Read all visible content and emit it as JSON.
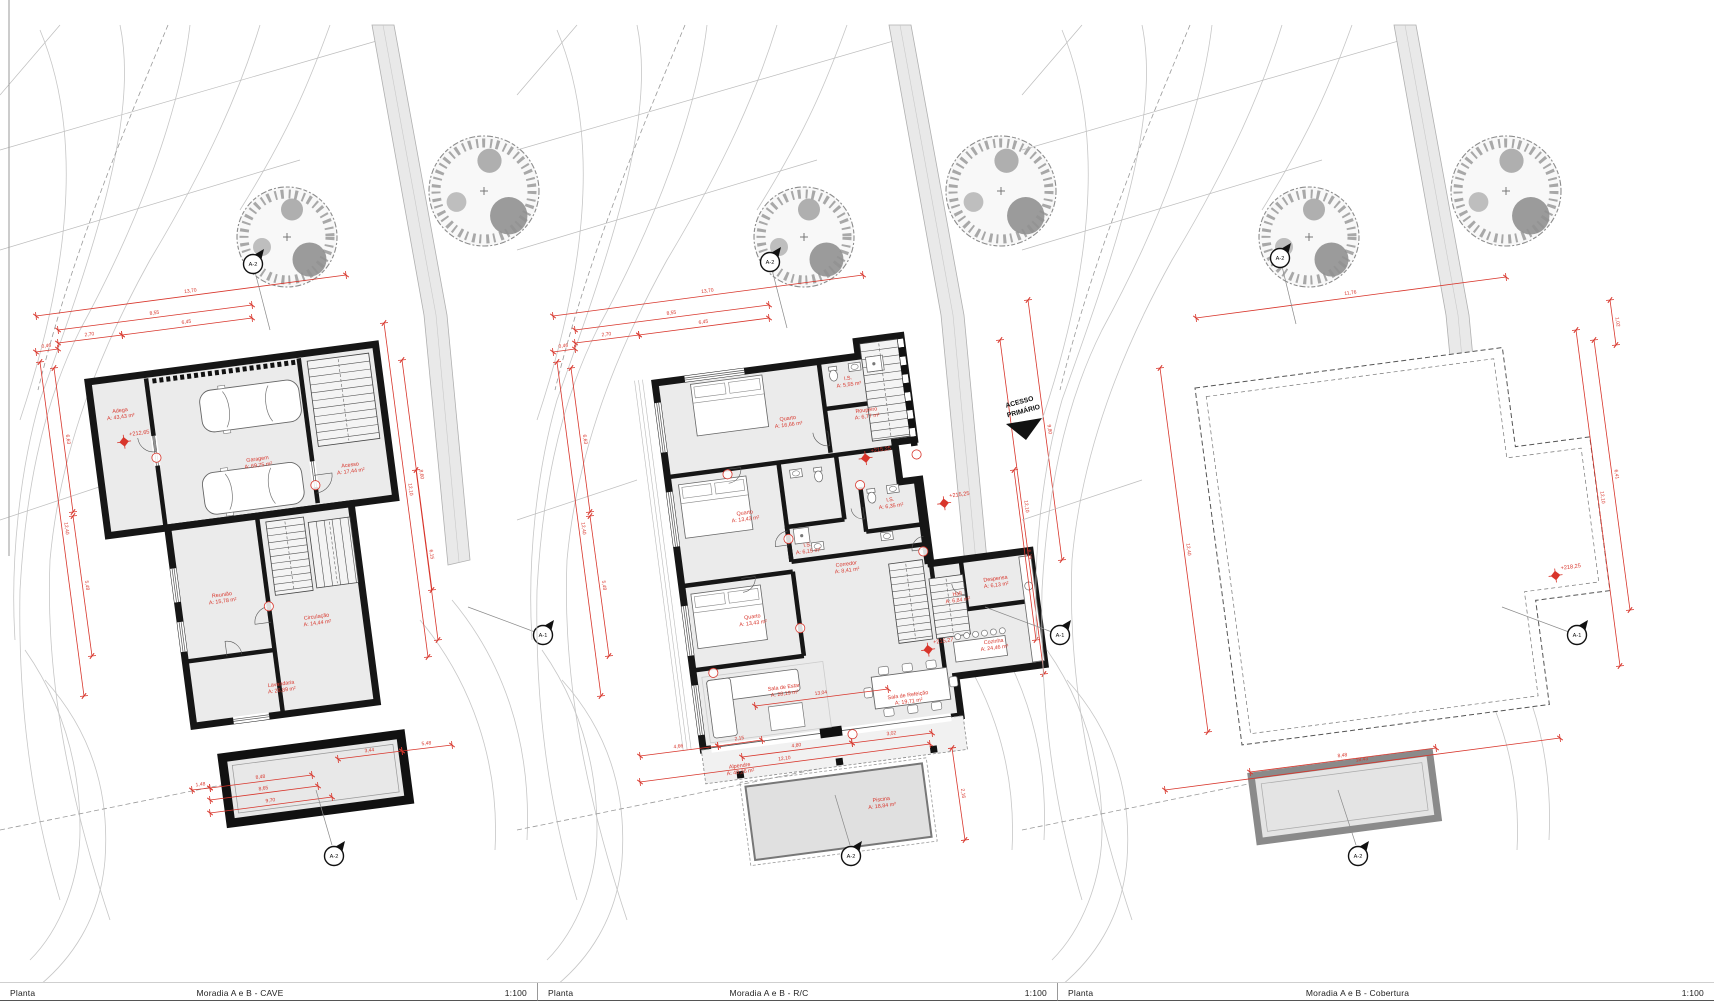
{
  "sheet": {
    "type_label": "Planta",
    "scale": "1:100"
  },
  "footer": {
    "segments": [
      {
        "label": "Planta",
        "title": "Moradia A e B - CAVE",
        "scale": "1:100"
      },
      {
        "label": "Planta",
        "title": "Moradia A e B - R/C",
        "scale": "1:100"
      },
      {
        "label": "Planta",
        "title": "Moradia A e B - Cobertura",
        "scale": "1:100"
      }
    ]
  },
  "markers": {
    "side_label": "A-1",
    "cross_label": "A-2"
  },
  "accent_red": "#d8352b",
  "panels": [
    {
      "id": "cave",
      "title": "Moradia A e B - CAVE",
      "rooms": [
        {
          "name": "Adega",
          "area": "A: 43,43 m²",
          "x": 28,
          "y": 34
        },
        {
          "name": "Garagem",
          "area": "A: 69,75 m²",
          "x": 158,
          "y": 100
        },
        {
          "name": "Acesso",
          "area": "A: 17,44 m²",
          "x": 249,
          "y": 118
        },
        {
          "name": "Reunião",
          "area": "A: 15,78 m²",
          "x": 105,
          "y": 230
        },
        {
          "name": "Circulação",
          "area": "A: 14,44 m²",
          "x": 196,
          "y": 264
        },
        {
          "name": "Lavandaria",
          "area": "A: 26,89 m²",
          "x": 152,
          "y": 326
        }
      ],
      "levels": [
        {
          "v": "+212,65",
          "x": 28,
          "y": 64
        }
      ],
      "dims": [
        {
          "x1": 36,
          "y1": 316,
          "x2": 346,
          "y2": 275,
          "v": "13,70"
        },
        {
          "x1": 58,
          "y1": 330,
          "x2": 252,
          "y2": 305,
          "v": "8,55"
        },
        {
          "x1": 58,
          "y1": 343,
          "x2": 122,
          "y2": 335,
          "v": "2,70"
        },
        {
          "x1": 122,
          "y1": 335,
          "x2": 252,
          "y2": 318,
          "v": "6,45"
        },
        {
          "x1": 36,
          "y1": 352,
          "x2": 58,
          "y2": 349,
          "v": "0,46"
        },
        {
          "x1": 40,
          "y1": 362,
          "x2": 84,
          "y2": 696,
          "v": "12,40"
        },
        {
          "x1": 54,
          "y1": 368,
          "x2": 73,
          "y2": 512,
          "v": "6,63"
        },
        {
          "x1": 73,
          "y1": 516,
          "x2": 92,
          "y2": 656,
          "v": "5,48"
        },
        {
          "x1": 384,
          "y1": 323,
          "x2": 428,
          "y2": 657,
          "v": "12,10"
        },
        {
          "x1": 402,
          "y1": 360,
          "x2": 432,
          "y2": 590,
          "v": "8,60"
        },
        {
          "x1": 416,
          "y1": 470,
          "x2": 438,
          "y2": 640,
          "v": "6,15"
        },
        {
          "x1": 192,
          "y1": 790,
          "x2": 210,
          "y2": 788,
          "v": "1,48"
        },
        {
          "x1": 210,
          "y1": 788,
          "x2": 312,
          "y2": 775,
          "v": "8,48"
        },
        {
          "x1": 210,
          "y1": 800,
          "x2": 318,
          "y2": 786,
          "v": "8,65"
        },
        {
          "x1": 210,
          "y1": 813,
          "x2": 332,
          "y2": 797,
          "v": "9,70"
        },
        {
          "x1": 338,
          "y1": 759,
          "x2": 402,
          "y2": 751,
          "v": "3,44"
        },
        {
          "x1": 402,
          "y1": 751,
          "x2": 452,
          "y2": 745,
          "v": "5,48"
        }
      ]
    },
    {
      "id": "rc",
      "title": "Moradia A e B - R/C",
      "access_note_1": "ACESSO",
      "access_note_2": "PRIMÁRIO",
      "rooms": [
        {
          "name": "Quarto",
          "area": "A: 16,66 m²",
          "x": 127,
          "y": 54
        },
        {
          "name": "I.S.",
          "area": "A: 5,55 m²",
          "x": 192,
          "y": 22
        },
        {
          "name": "Roupeiro",
          "area": "A: 6,77 m²",
          "x": 206,
          "y": 56
        },
        {
          "name": "Quarto",
          "area": "A: 13,43 m²",
          "x": 72,
          "y": 142
        },
        {
          "name": "I.S.",
          "area": "A: 6,35 m²",
          "x": 218,
          "y": 148
        },
        {
          "name": "I.S.",
          "area": "A: 6,15 m²",
          "x": 130,
          "y": 182
        },
        {
          "name": "Corredor",
          "area": "A: 8,41 m²",
          "x": 166,
          "y": 206
        },
        {
          "name": "Quarto",
          "area": "A: 13,43 m²",
          "x": 66,
          "y": 246
        },
        {
          "name": "Hall",
          "area": "A: 6,84 m²",
          "x": 272,
          "y": 250
        },
        {
          "name": "Despensa",
          "area": "A: 6,13 m²",
          "x": 312,
          "y": 240
        },
        {
          "name": "Cozinha",
          "area": "A: 24,46 m²",
          "x": 302,
          "y": 302
        },
        {
          "name": "Sala de Estar",
          "area": "A: 28,19 m²",
          "x": 88,
          "y": 320
        },
        {
          "name": "Sala de Refeição",
          "area": "A: 19,71 m²",
          "x": 210,
          "y": 344
        },
        {
          "name": "Alpendre",
          "area": "A: 40,26 m²",
          "x": 34,
          "y": 392
        },
        {
          "name": "Piscina",
          "area": "A: 18,84 m²",
          "x": 170,
          "y": 444
        }
      ],
      "levels": [
        {
          "v": "+215,25",
          "x": 199,
          "y": 102
        },
        {
          "v": "+215,25",
          "x": 271,
          "y": 157
        },
        {
          "v": "+215,27",
          "x": 236,
          "y": 300
        }
      ],
      "dims": [
        {
          "x1": 553,
          "y1": 316,
          "x2": 863,
          "y2": 275,
          "v": "13,70"
        },
        {
          "x1": 575,
          "y1": 330,
          "x2": 769,
          "y2": 305,
          "v": "8,55"
        },
        {
          "x1": 575,
          "y1": 343,
          "x2": 639,
          "y2": 335,
          "v": "2,70"
        },
        {
          "x1": 639,
          "y1": 335,
          "x2": 769,
          "y2": 318,
          "v": "6,45"
        },
        {
          "x1": 553,
          "y1": 352,
          "x2": 575,
          "y2": 349,
          "v": "0,46"
        },
        {
          "x1": 557,
          "y1": 362,
          "x2": 601,
          "y2": 696,
          "v": "12,40"
        },
        {
          "x1": 571,
          "y1": 368,
          "x2": 590,
          "y2": 512,
          "v": "6,63"
        },
        {
          "x1": 590,
          "y1": 516,
          "x2": 609,
          "y2": 656,
          "v": "5,48"
        },
        {
          "x1": 1000,
          "y1": 340,
          "x2": 1044,
          "y2": 674,
          "v": "12,10"
        },
        {
          "x1": 1014,
          "y1": 470,
          "x2": 1036,
          "y2": 640,
          "v": "6,15"
        },
        {
          "x1": 1028,
          "y1": 300,
          "x2": 1062,
          "y2": 560,
          "v": "9,80"
        },
        {
          "x1": 640,
          "y1": 756,
          "x2": 718,
          "y2": 746,
          "v": "4,66"
        },
        {
          "x1": 718,
          "y1": 746,
          "x2": 762,
          "y2": 740,
          "v": "2,15"
        },
        {
          "x1": 640,
          "y1": 782,
          "x2": 930,
          "y2": 744,
          "v": "12,10"
        },
        {
          "x1": 755,
          "y1": 706,
          "x2": 888,
          "y2": 689,
          "v": "13,04"
        },
        {
          "x1": 742,
          "y1": 757,
          "x2": 852,
          "y2": 743,
          "v": "4,80"
        },
        {
          "x1": 852,
          "y1": 743,
          "x2": 932,
          "y2": 733,
          "v": "3,02"
        },
        {
          "x1": 952,
          "y1": 748,
          "x2": 965,
          "y2": 840,
          "v": "2,16"
        }
      ]
    },
    {
      "id": "cobertura",
      "title": "Moradia A e B - Cobertura",
      "levels": [
        {
          "v": "+218,25",
          "x": 333,
          "y": 233
        }
      ],
      "dims": [
        {
          "x1": 1196,
          "y1": 318,
          "x2": 1506,
          "y2": 277,
          "v": "11,76"
        },
        {
          "x1": 1160,
          "y1": 368,
          "x2": 1208,
          "y2": 732,
          "v": "12,40"
        },
        {
          "x1": 1576,
          "y1": 330,
          "x2": 1620,
          "y2": 666,
          "v": "12,10"
        },
        {
          "x1": 1594,
          "y1": 340,
          "x2": 1630,
          "y2": 610,
          "v": "6,41"
        },
        {
          "x1": 1610,
          "y1": 300,
          "x2": 1616,
          "y2": 345,
          "v": "1,02"
        },
        {
          "x1": 1250,
          "y1": 772,
          "x2": 1436,
          "y2": 748,
          "v": "8,48"
        },
        {
          "x1": 1165,
          "y1": 790,
          "x2": 1560,
          "y2": 738,
          "v": "18,43"
        }
      ]
    }
  ]
}
